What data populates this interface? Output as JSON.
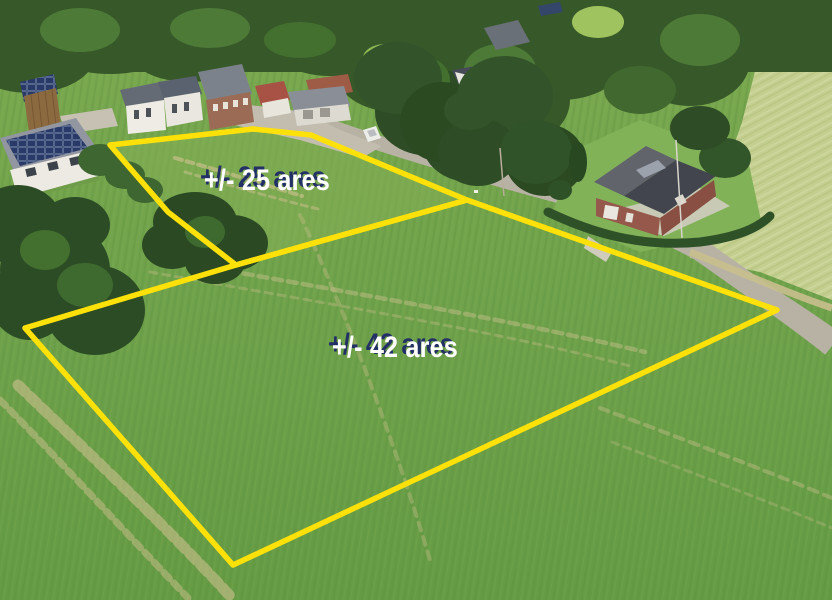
{
  "parcels": {
    "small": {
      "label": "+/- 25 ares",
      "area_ares": "25"
    },
    "large": {
      "label": "+/- 42 ares",
      "area_ares": "42"
    }
  },
  "colors": {
    "boundary_yellow": "#FFE10A",
    "label_text": "#FFFFFF",
    "label_shadow": "#233066",
    "field_green": "#6FA24B",
    "wheat_green": "#C3CE8F",
    "forest_green": "#375829",
    "road_gray": "#B8B2A4"
  },
  "geometry": {
    "small_plot_points": "110,145 253,129 311,135 467,200 236,265 168,212",
    "large_plot_points": "25,328 236,265 467,200 777,310 233,565"
  }
}
